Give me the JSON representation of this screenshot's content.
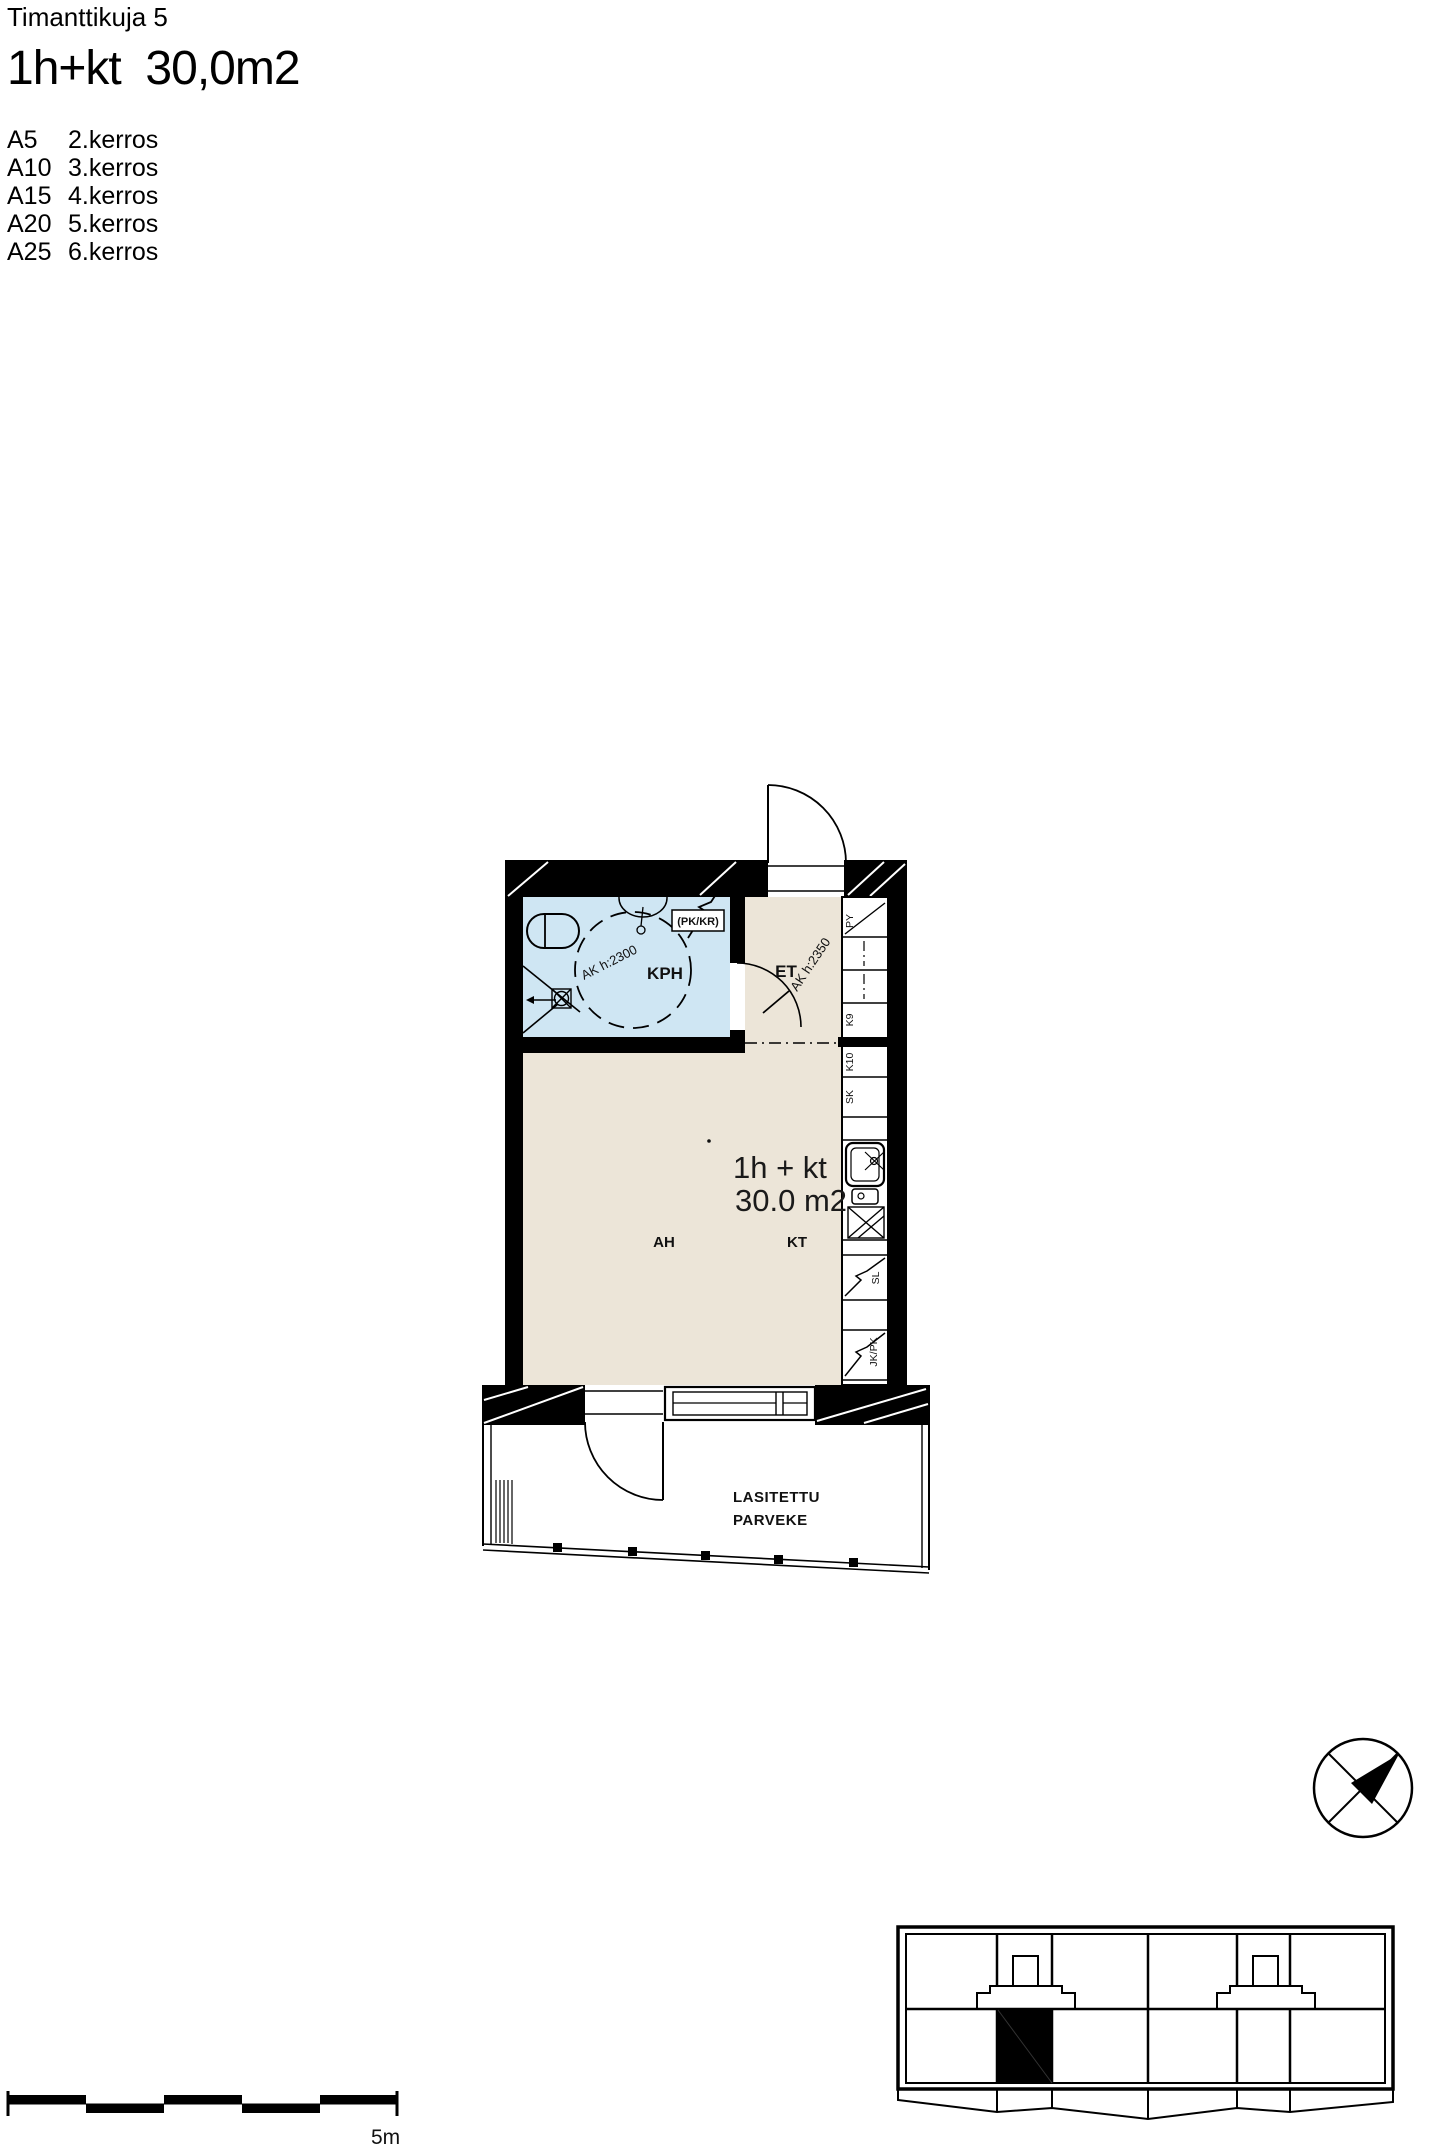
{
  "header": {
    "address": "Timanttikuja 5",
    "size_title": "1h+kt  30,0m2",
    "apartments": [
      {
        "code": "A5",
        "floor": "2.kerros"
      },
      {
        "code": "A10",
        "floor": "3.kerros"
      },
      {
        "code": "A15",
        "floor": "4.kerros"
      },
      {
        "code": "A20",
        "floor": "5.kerros"
      },
      {
        "code": "A25",
        "floor": "6.kerros"
      }
    ]
  },
  "plan": {
    "room_labels": {
      "bathroom": "KPH",
      "entry": "ET",
      "living": "AH",
      "kitchen": "KT"
    },
    "area_label": {
      "line1": "1h + kt",
      "line2": "30.0 m2"
    },
    "balcony_label": {
      "line1": "LASITETTU",
      "line2": "PARVEKE"
    },
    "annotations": {
      "bathroom_ceiling": "AK h:2300",
      "entry_ceiling": "AK h:2350",
      "washer_dryer": "(PK/KR)"
    },
    "cabinets": {
      "py": "PY",
      "k9": "K9",
      "k10": "K10",
      "sk": "SK",
      "sl": "SL",
      "jk_pk": "JK/PK"
    }
  },
  "scale_bar": {
    "label": "5m"
  },
  "colors": {
    "floor": "#ece5d8",
    "bathroom": "#cfe6f3",
    "wall": "#000000"
  }
}
